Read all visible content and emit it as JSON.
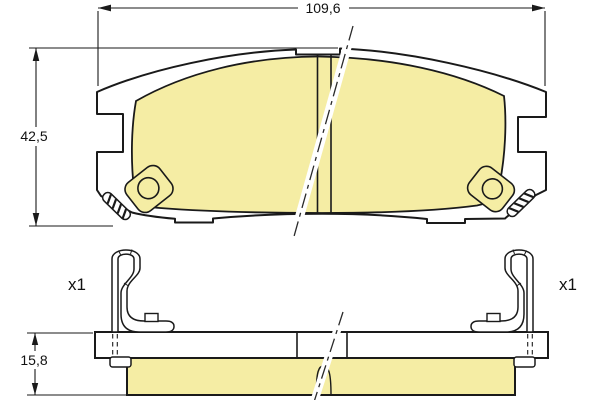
{
  "diagram": {
    "type": "brake-pad-set-technical-drawing",
    "views": {
      "front": {
        "width_label": "109,6",
        "height_label": "42,5"
      },
      "side": {
        "thickness_label": "15,8",
        "clip_quantity_left": "x1",
        "clip_quantity_right": "x1"
      }
    },
    "colors": {
      "friction_material": "#F5EDA4",
      "outline": "#1A1A1A",
      "background": "#FFFFFF"
    }
  }
}
